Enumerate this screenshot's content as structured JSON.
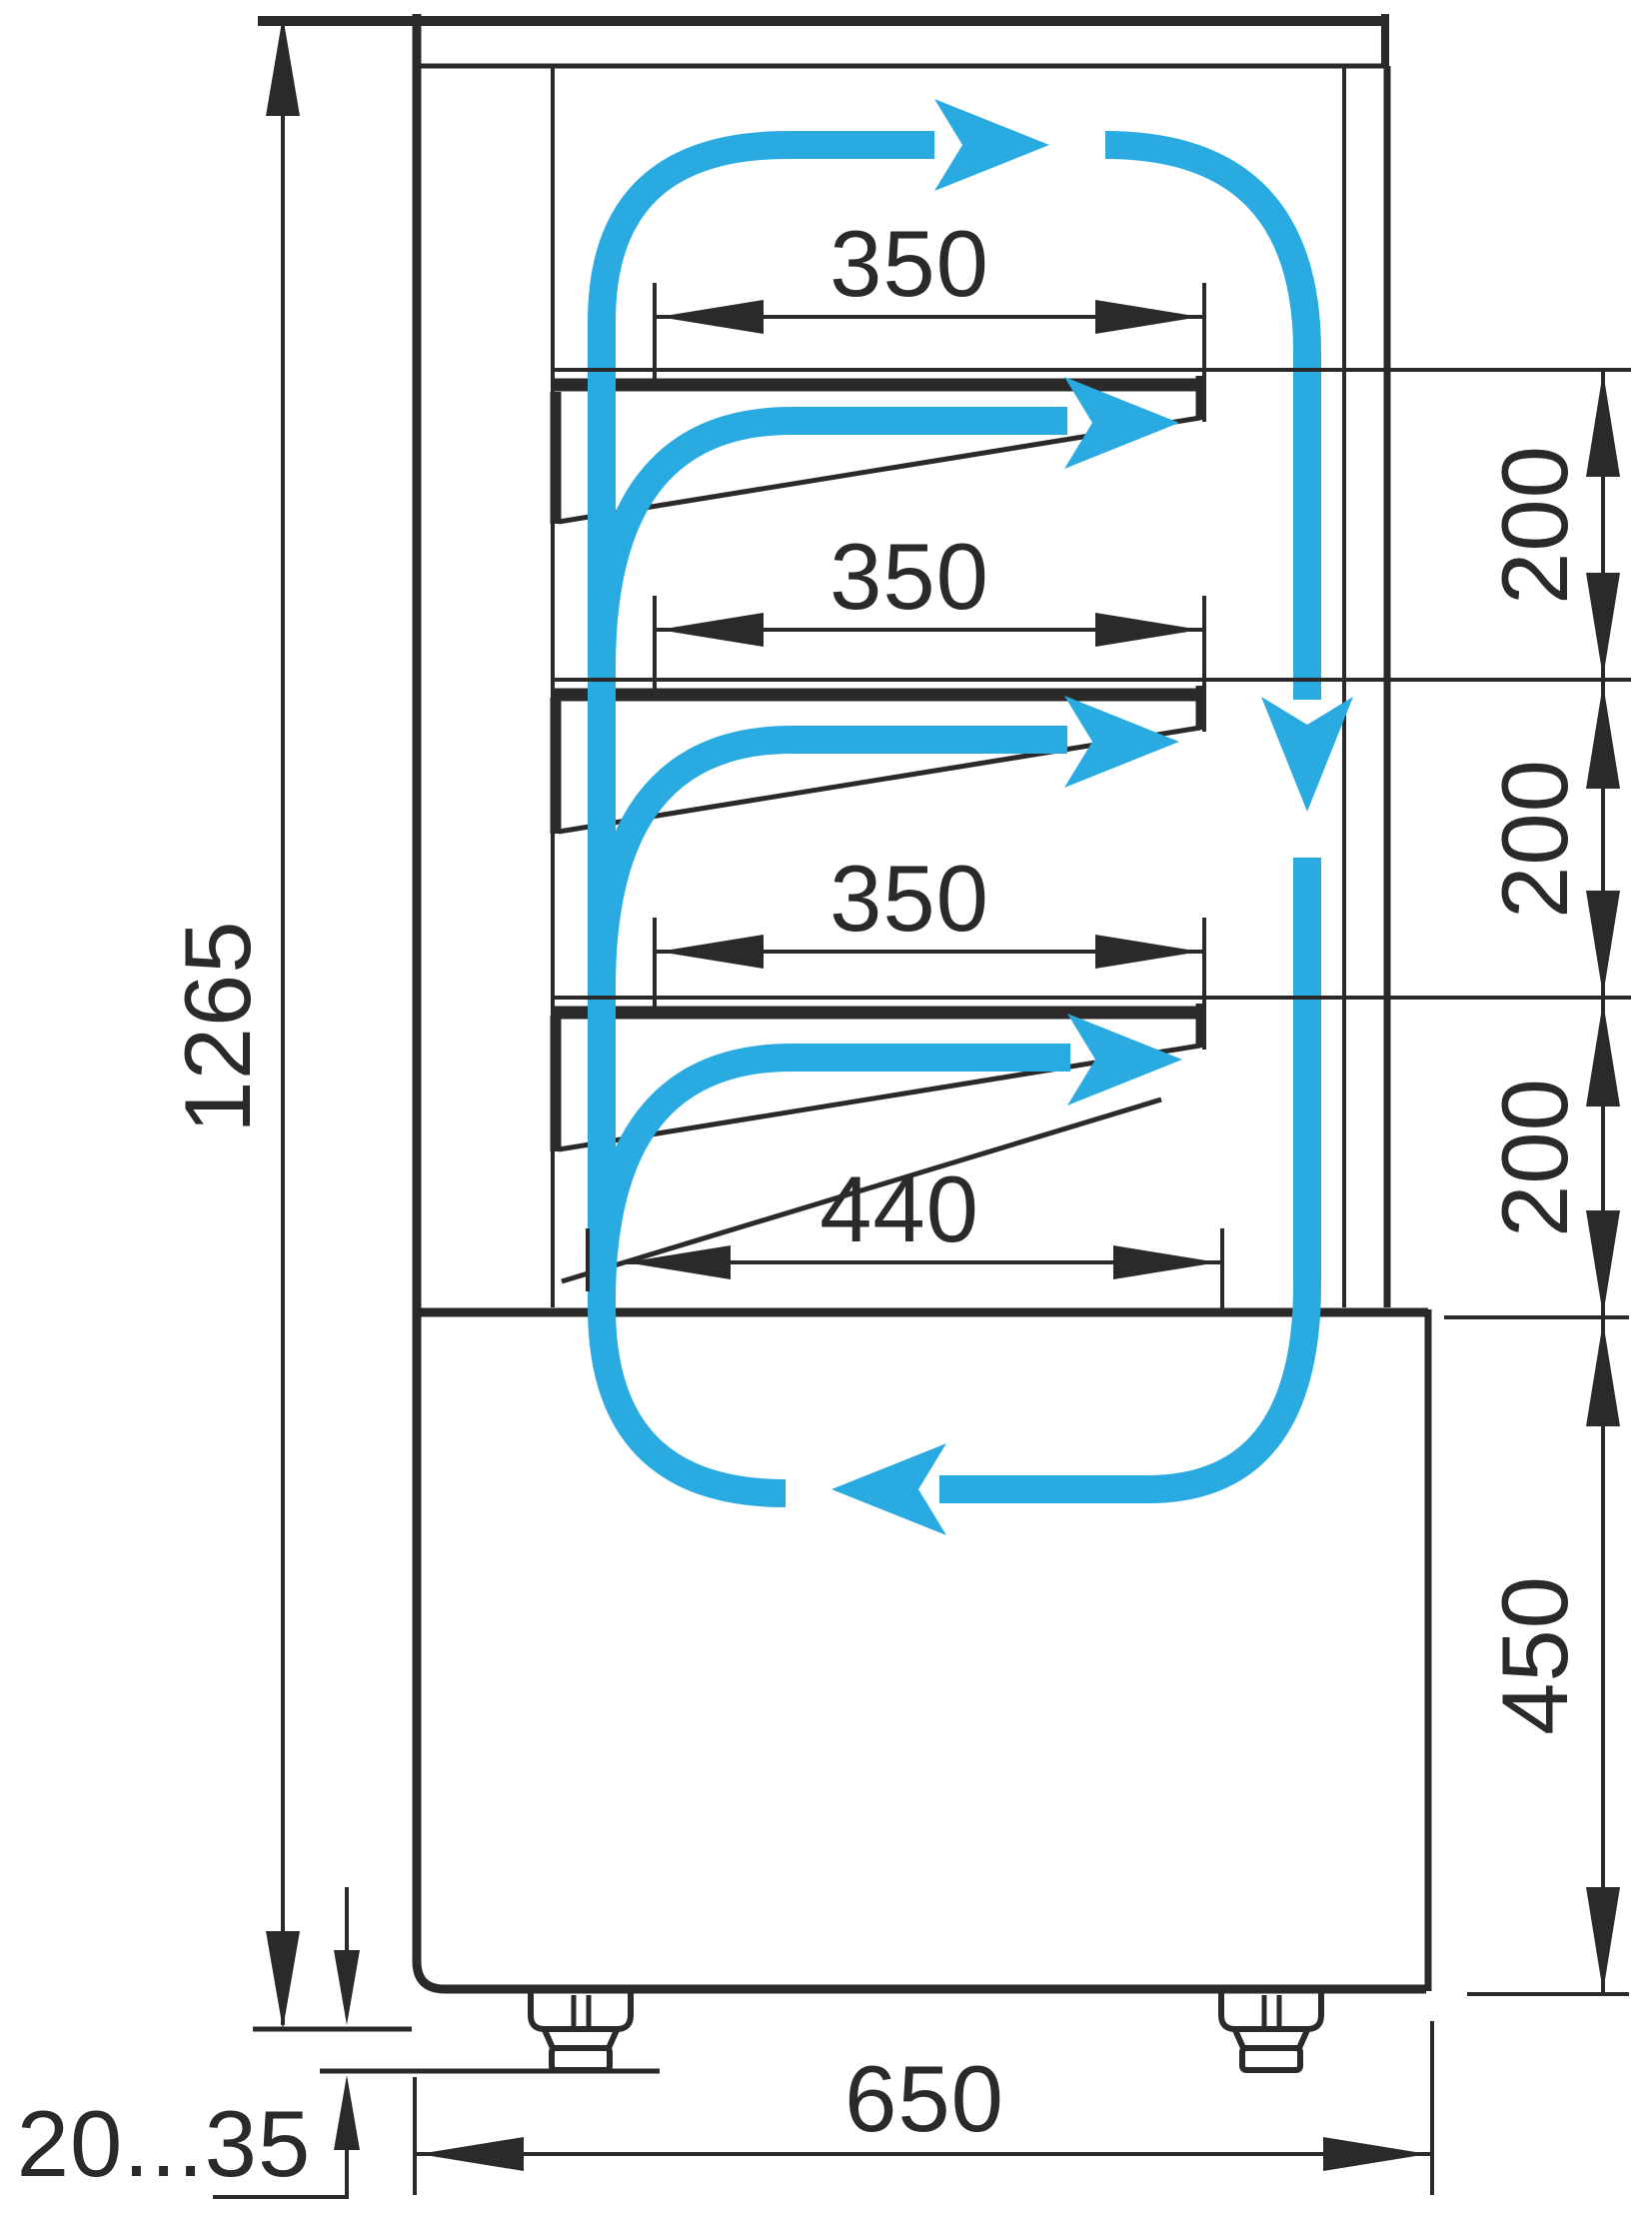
{
  "drawing": {
    "labels": {
      "overall_height": "1265",
      "shelf_top_depth": "350",
      "shelf_middle_depth": "350",
      "shelf_bottom_depth": "350",
      "base_shelf_depth": "440",
      "gap_top": "200",
      "gap_middle": "200",
      "gap_bottom": "200",
      "base_height": "450",
      "overall_depth": "650",
      "feet_adjust_range": "20...35"
    },
    "colors": {
      "airflow": "#29abe2",
      "ink": "#2b2a29",
      "background": "#ffffff"
    }
  }
}
